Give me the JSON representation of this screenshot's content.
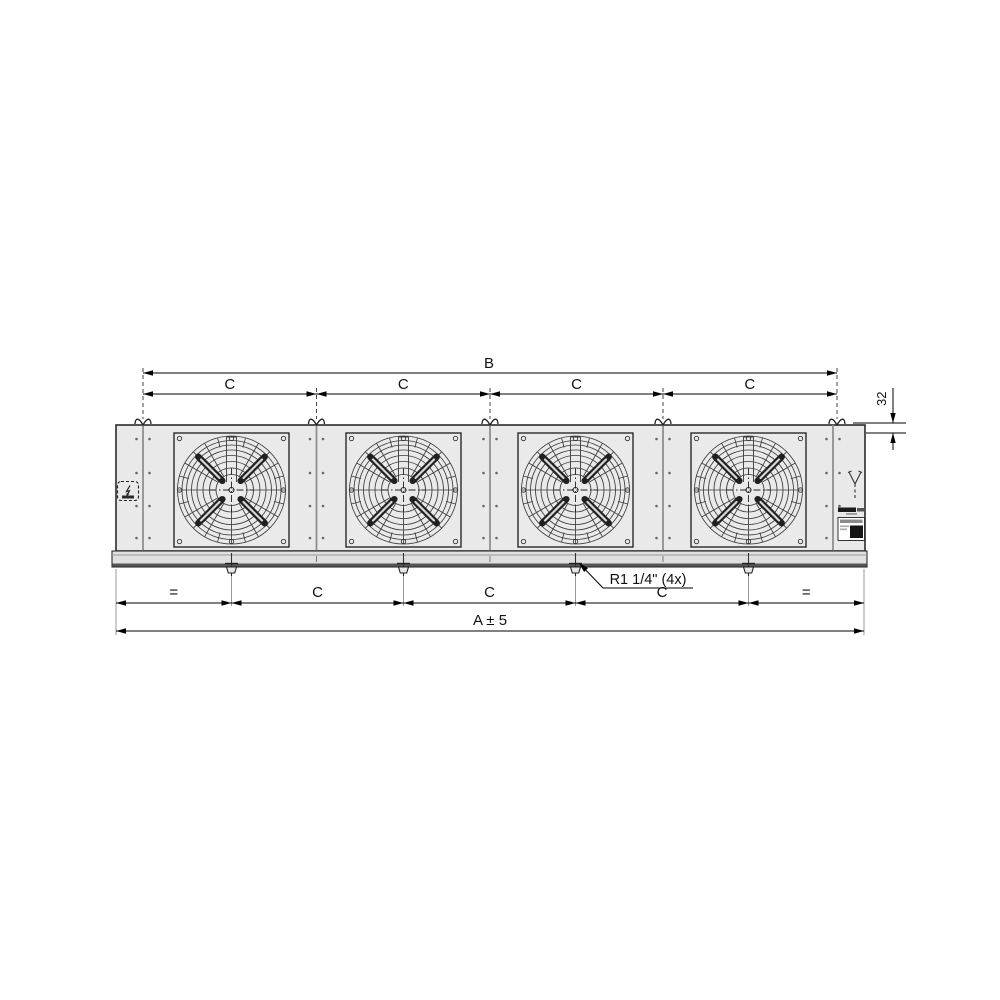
{
  "diagram": {
    "subject": "unit-cooler-4-fan-front-view-technical-drawing",
    "dims": {
      "b": "B",
      "c_top": [
        "C",
        "C",
        "C",
        "C"
      ],
      "offset_32": "32",
      "bottom": [
        "=",
        "C",
        "C",
        "C",
        "="
      ],
      "a": "A ± 5",
      "drain_note": "R1 1/4\" (4x)"
    },
    "icons": {
      "hanger": "hanger-bracket-icon",
      "electrical": "electrical-connection-icon",
      "pipe": "pipe-connection-icon",
      "logo": "brand-logo-mark",
      "label": "rating-plate"
    },
    "colors": {
      "background": "#ffffff",
      "casing_fill": "#e9e9e9",
      "tray_fill": "#e0e0e0",
      "tray_shadow": "#555555",
      "outline": "#2b2b2b",
      "seam": "#8f8f8f",
      "guard_line": "#3a3a3a",
      "blade": "#202020",
      "dimension": "#000000"
    }
  }
}
